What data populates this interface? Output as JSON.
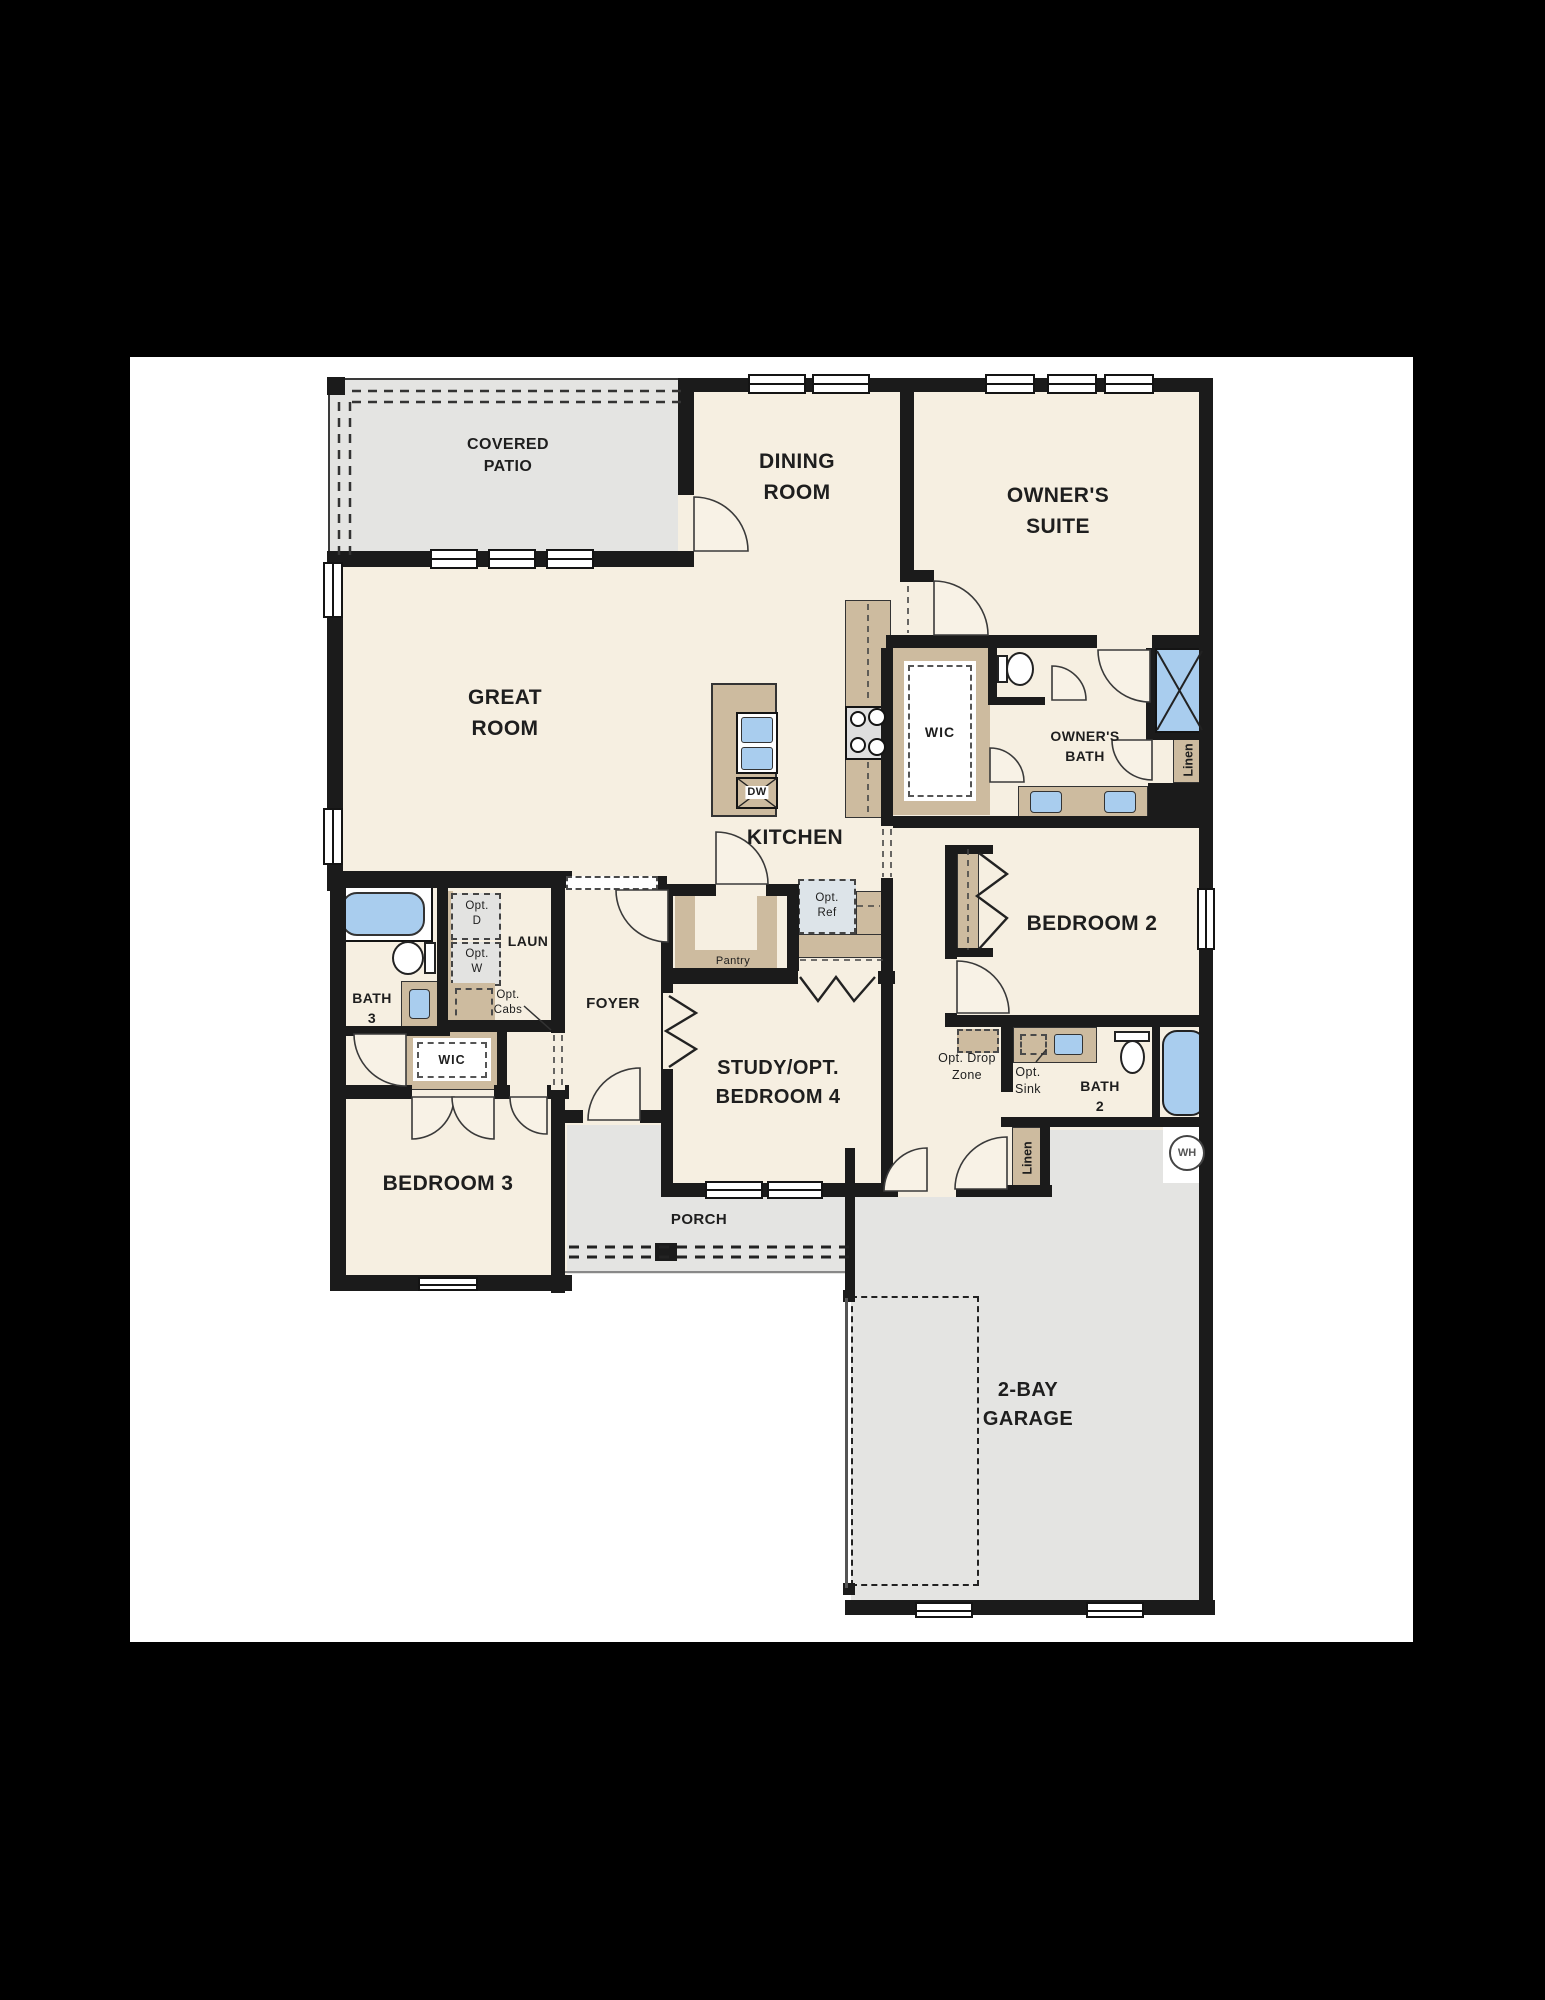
{
  "colors": {
    "wall": "#1b1b1b",
    "room_fill": "#f6efe1",
    "outdoor_fill": "#e4e4e2",
    "cabinet_fill": "#cdbb9f",
    "fixture_blue": "#a9cdee",
    "opt_fill": "#e3e3e1",
    "opt_ref_fill": "#dde4e9",
    "paper": "#ffffff",
    "background": "#000000"
  },
  "labels": {
    "covered_patio": [
      "COVERED",
      "PATIO"
    ],
    "dining_room": [
      "DINING",
      "ROOM"
    ],
    "owners_suite": [
      "OWNER'S",
      "SUITE"
    ],
    "great_room": [
      "GREAT",
      "ROOM"
    ],
    "kitchen": [
      "KITCHEN"
    ],
    "wic_owner": [
      "WIC"
    ],
    "owners_bath": [
      "OWNER'S",
      "BATH"
    ],
    "linen_bath": [
      "Linen"
    ],
    "bedroom2": [
      "BEDROOM 2"
    ],
    "opt_drop_zone": [
      "Opt. Drop",
      "Zone"
    ],
    "opt_sink": [
      "Opt.",
      "Sink"
    ],
    "bath2": [
      "BATH",
      "2"
    ],
    "linen_hall": [
      "Linen"
    ],
    "water_heater": [
      "WH"
    ],
    "bath3": [
      "BATH",
      "3"
    ],
    "opt_dryer": [
      "Opt.",
      "D"
    ],
    "opt_washer": [
      "Opt.",
      "W"
    ],
    "laundry": [
      "LAUN"
    ],
    "opt_cabs": [
      "Opt.",
      "Cabs"
    ],
    "wic_bed3": [
      "WIC"
    ],
    "foyer": [
      "FOYER"
    ],
    "pantry": [
      "Pantry"
    ],
    "study": [
      "STUDY/OPT.",
      "BEDROOM 4"
    ],
    "bedroom3": [
      "BEDROOM 3"
    ],
    "porch": [
      "PORCH"
    ],
    "garage": [
      "2-BAY",
      "GARAGE"
    ],
    "dishwasher": [
      "DW"
    ],
    "opt_ref": [
      "Opt.",
      "Ref"
    ]
  }
}
